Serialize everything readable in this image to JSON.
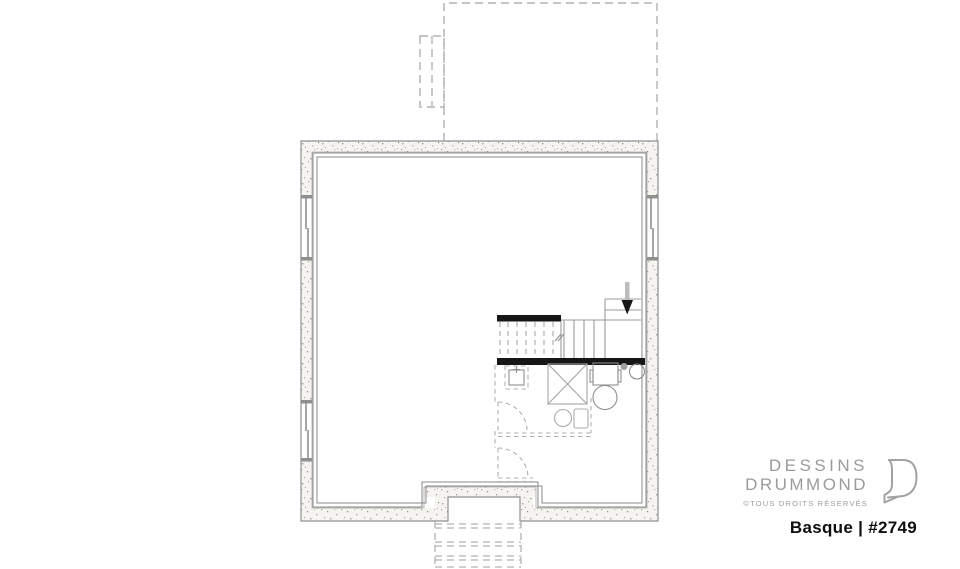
{
  "branding": {
    "brand_line1": "DESSINS",
    "brand_line2": "DRUMMOND",
    "copyright": "©TOUS DROITS RÉSERVÉS",
    "plan_name": "Basque | #2749",
    "brand_color": "#9b9b9b",
    "plan_name_color": "#0f0f0f",
    "logo_icon": "drummond-d-logo"
  },
  "plan": {
    "kind": "basement-floor-plan",
    "colors": {
      "wall_fill": "#f5f4f1",
      "wall_speckle": "#a39f99",
      "wall_outline": "#8f8f8f",
      "interior_lines": "#8a8a8a",
      "stair_header_bars": "#161616",
      "stair_lines": "#9b9b9b",
      "dashed_future_work": "#aeaeae",
      "direction_arrow": "#161616"
    },
    "icons": {
      "stair_direction_arrow": "down-arrow-icon"
    }
  }
}
